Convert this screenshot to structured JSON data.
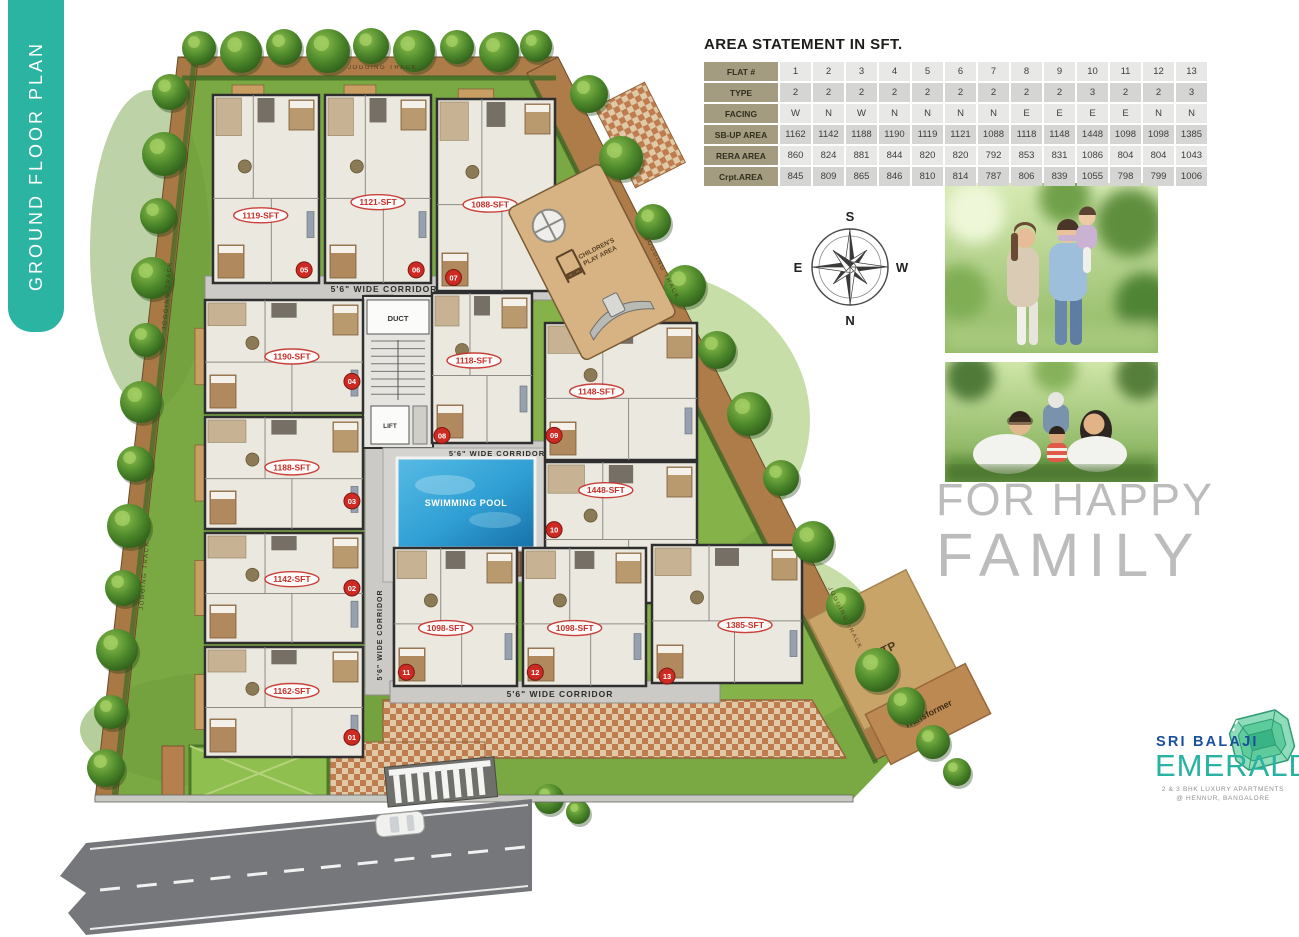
{
  "sidebar": {
    "label": "GROUND FLOOR PLAN",
    "color": "#2cb4a3"
  },
  "area_statement": {
    "title": "AREA STATEMENT IN SFT.",
    "rows": [
      {
        "header": "FLAT #",
        "values": [
          "1",
          "2",
          "3",
          "4",
          "5",
          "6",
          "7",
          "8",
          "9",
          "10",
          "11",
          "12",
          "13"
        ]
      },
      {
        "header": "TYPE",
        "values": [
          "2",
          "2",
          "2",
          "2",
          "2",
          "2",
          "2",
          "2",
          "2",
          "3",
          "2",
          "2",
          "3"
        ]
      },
      {
        "header": "FACING",
        "values": [
          "W",
          "N",
          "W",
          "N",
          "N",
          "N",
          "N",
          "E",
          "E",
          "E",
          "E",
          "N",
          "N"
        ]
      },
      {
        "header": "SB-UP AREA",
        "values": [
          "1162",
          "1142",
          "1188",
          "1190",
          "1119",
          "1121",
          "1088",
          "1118",
          "1148",
          "1448",
          "1098",
          "1098",
          "1385"
        ]
      },
      {
        "header": "RERA AREA",
        "values": [
          "860",
          "824",
          "881",
          "844",
          "820",
          "820",
          "792",
          "853",
          "831",
          "1086",
          "804",
          "804",
          "1043"
        ]
      },
      {
        "header": "Crpt.AREA",
        "values": [
          "845",
          "809",
          "865",
          "846",
          "810",
          "814",
          "787",
          "806",
          "839",
          "1055",
          "798",
          "799",
          "1006"
        ]
      }
    ]
  },
  "plan": {
    "units": [
      {
        "badge": "05",
        "area_label": "1119-SFT"
      },
      {
        "badge": "06",
        "area_label": "1121-SFT"
      },
      {
        "badge": "07",
        "area_label": "1088-SFT"
      },
      {
        "badge": "04",
        "area_label": "1190-SFT"
      },
      {
        "badge": "03",
        "area_label": "1188-SFT"
      },
      {
        "badge": "02",
        "area_label": "1142-SFT"
      },
      {
        "badge": "01",
        "area_label": "1162-SFT"
      },
      {
        "badge": "08",
        "area_label": "1118-SFT"
      },
      {
        "badge": "09",
        "area_label": "1148-SFT"
      },
      {
        "badge": "10",
        "area_label": "1448-SFT"
      },
      {
        "badge": "11",
        "area_label": "1098-SFT"
      },
      {
        "badge": "12",
        "area_label": "1098-SFT"
      },
      {
        "badge": "13",
        "area_label": "1385-SFT"
      }
    ],
    "labels": {
      "swimming_pool": "SWIMMING POOL",
      "play_area_1": "CHILDREN'S",
      "play_area_2": "PLAY AREA",
      "corridor": "5'6\" WIDE CORRIDOR",
      "jogging_track": "JOGGING TRACK",
      "duct": "DUCT",
      "lift": "LIFT",
      "stp": "STP",
      "transformer": "Transformer"
    },
    "compass": {
      "top": "S",
      "left": "E",
      "right": "W",
      "bottom": "N"
    }
  },
  "right_panel": {
    "tagline_line1": "FOR HAPPY",
    "tagline_line2": "FAMILY"
  },
  "logo": {
    "name_top": "SRI BALAJI",
    "name_main": "EMERALD",
    "sub1": "2 & 3 BHK LUXURY APARTMENTS",
    "sub2": "@ HENNUR, BANGALORE"
  },
  "colors": {
    "teal": "#2cb4a3",
    "lawn": "#7aa843",
    "track": "#ad7c48",
    "pool": "#2f9fd4",
    "unit_label_red": "#c62f28",
    "logo_blue": "#1a4f9c"
  }
}
